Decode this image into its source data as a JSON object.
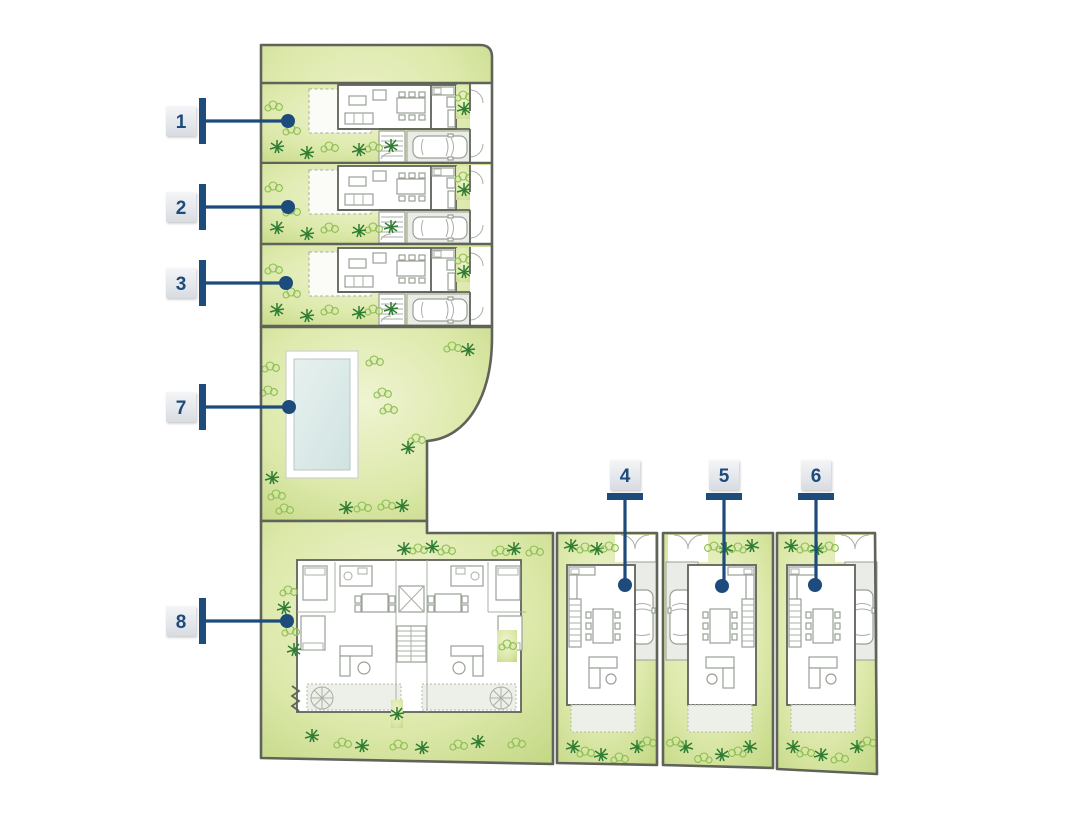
{
  "plan": {
    "markers": [
      {
        "number": "1",
        "target": "townhouse-row-1"
      },
      {
        "number": "2",
        "target": "townhouse-row-2"
      },
      {
        "number": "3",
        "target": "townhouse-row-3"
      },
      {
        "number": "4",
        "target": "townhouse-column-1"
      },
      {
        "number": "5",
        "target": "townhouse-column-2"
      },
      {
        "number": "6",
        "target": "townhouse-column-3"
      },
      {
        "number": "7",
        "target": "pool-garden"
      },
      {
        "number": "8",
        "target": "apartment-building"
      }
    ],
    "colors": {
      "marker_navy": "#1d4b7c",
      "wall_gray": "#5f635a",
      "garden_green": "#cfe093",
      "plant_dark_green": "#2f7d33",
      "plant_light_green": "#8bbf4e",
      "pool_blue": "#d8e8e6",
      "terrace_gray": "#edefe9",
      "marker_box_gray": "#e3e6ea"
    }
  }
}
